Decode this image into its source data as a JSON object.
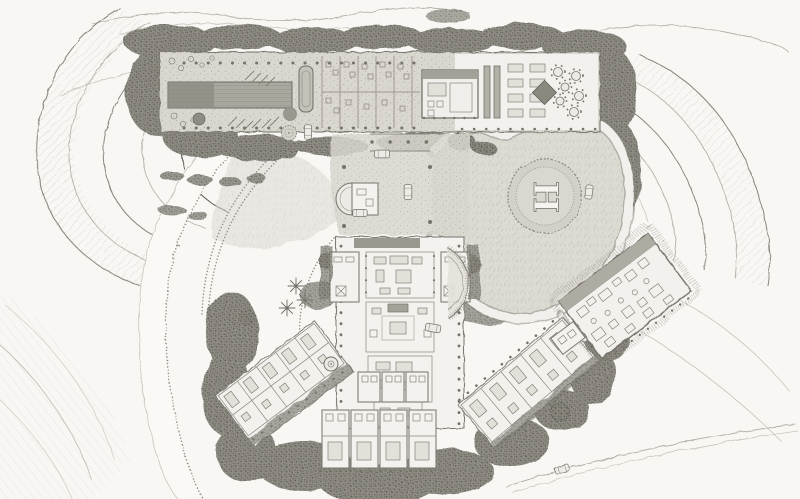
{
  "artwork": {
    "kind": "hand-drawn pencil site plan of a hillside estate",
    "orientation": "aerial plan view",
    "visible_text_count": 1
  },
  "labels": {
    "helipad_marking": "H"
  },
  "palette": {
    "paper": "#f8f7f4",
    "pencil_line": "#8a877f",
    "pencil_dark": "#5f5d56",
    "vegetation": "#87847c",
    "stone_platform": "#d8d6ce",
    "room_white": "#f3f2ee",
    "pool_water": "#9a978e",
    "lawn": "#dbd9d1"
  },
  "features": [
    {
      "name": "terraced-hillside-west",
      "kind": "terrain"
    },
    {
      "name": "terraced-hillside-east",
      "kind": "terrain"
    },
    {
      "name": "perimeter-vegetation",
      "kind": "planting"
    },
    {
      "name": "access-road-west",
      "kind": "road"
    },
    {
      "name": "garden-paths",
      "kind": "road"
    },
    {
      "name": "upper-garden-terrace",
      "kind": "building-terrace"
    },
    {
      "name": "swimming-pool",
      "kind": "water"
    },
    {
      "name": "lap-pool",
      "kind": "water"
    },
    {
      "name": "spa-service-rooms",
      "kind": "building"
    },
    {
      "name": "garden-pavilion",
      "kind": "building"
    },
    {
      "name": "dining-terrace",
      "kind": "terrace",
      "rect_tables": 8,
      "round_tables": 6
    },
    {
      "name": "entry-gate-pergola",
      "kind": "structure"
    },
    {
      "name": "motor-court",
      "kind": "court",
      "parked_cars": 4
    },
    {
      "name": "apse-chapel",
      "kind": "structure"
    },
    {
      "name": "helipad-lawn",
      "kind": "lawn"
    },
    {
      "name": "helipad",
      "kind": "pad",
      "marking": "H"
    },
    {
      "name": "loop-road",
      "kind": "road",
      "cars_on_road": 1
    },
    {
      "name": "main-pavilion",
      "kind": "building",
      "courtyards": 4
    },
    {
      "name": "exedra",
      "kind": "structure"
    },
    {
      "name": "palm-garden",
      "kind": "planting",
      "palms": 3
    },
    {
      "name": "west-guest-wing",
      "kind": "building"
    },
    {
      "name": "south-guest-wing",
      "kind": "building",
      "room_modules": 4
    },
    {
      "name": "southeast-guest-wing",
      "kind": "building"
    },
    {
      "name": "service-building",
      "kind": "building"
    },
    {
      "name": "southeast-road",
      "kind": "road",
      "cars_on_road": 1
    },
    {
      "name": "cars-total-visible",
      "kind": "vehicles",
      "count": 7
    }
  ]
}
